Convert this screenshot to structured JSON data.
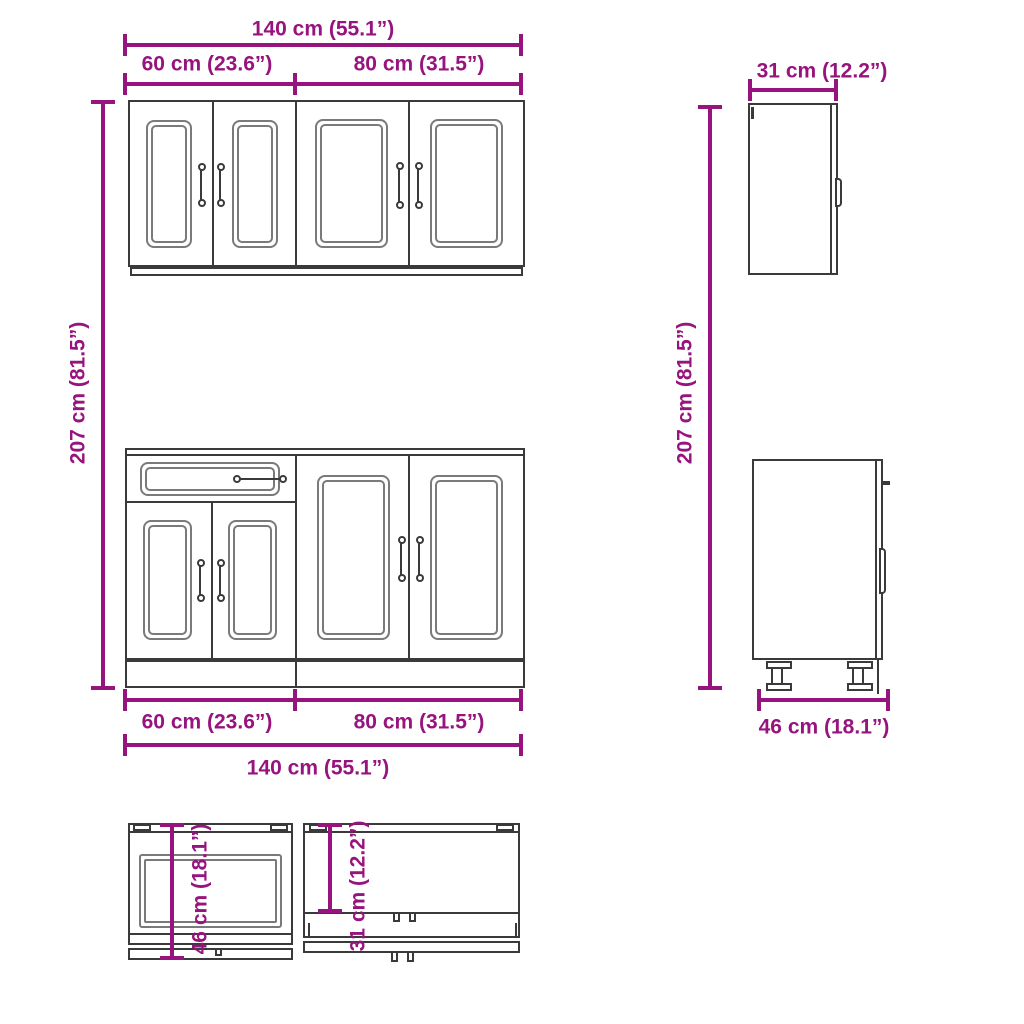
{
  "diagram": {
    "wall_section": {
      "front": {
        "total_width": "140 cm (55.1”)",
        "left_unit_width": "60 cm (23.6”)",
        "right_unit_width": "80 cm (31.5”)"
      },
      "side": {
        "depth": "31 cm (12.2”)"
      }
    },
    "overall": {
      "height_left": "207 cm (81.5”)",
      "height_right": "207 cm (81.5”)"
    },
    "base_section": {
      "front": {
        "left_unit_width": "60 cm (23.6”)",
        "right_unit_width": "80 cm (31.5”)",
        "total_width": "140 cm (55.1”)"
      },
      "side": {
        "depth": "46 cm (18.1”)"
      }
    },
    "top_view": {
      "base_depth": "46 cm (18.1”)",
      "wall_depth": "31 cm (12.2”)"
    }
  },
  "colors": {
    "dimension": "#97137D",
    "cabinet_outline": "#3A3A3A",
    "panel_line": "#7A7A7A",
    "background": "#FFFFFF"
  }
}
